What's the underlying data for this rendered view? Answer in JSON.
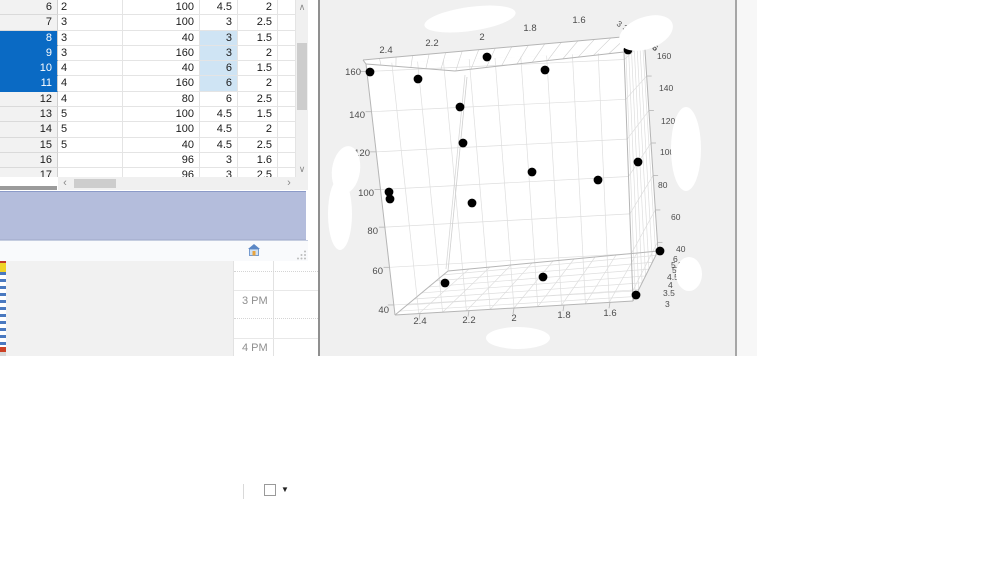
{
  "table": {
    "selection_color": "#0a6ac4",
    "cell_highlight_color": "#cfe4f4",
    "rows": [
      {
        "n": "6",
        "c1": "2",
        "c2": "100",
        "c3": "4.5",
        "c4": "2",
        "sel": false,
        "hl": false
      },
      {
        "n": "7",
        "c1": "3",
        "c2": "100",
        "c3": "3",
        "c4": "2.5",
        "sel": false,
        "hl": false
      },
      {
        "n": "8",
        "c1": "3",
        "c2": "40",
        "c3": "3",
        "c4": "1.5",
        "sel": true,
        "hl": true
      },
      {
        "n": "9",
        "c1": "3",
        "c2": "160",
        "c3": "3",
        "c4": "2",
        "sel": true,
        "hl": true
      },
      {
        "n": "10",
        "c1": "4",
        "c2": "40",
        "c3": "6",
        "c4": "1.5",
        "sel": true,
        "hl": true
      },
      {
        "n": "11",
        "c1": "4",
        "c2": "160",
        "c3": "6",
        "c4": "2",
        "sel": true,
        "hl": true
      },
      {
        "n": "12",
        "c1": "4",
        "c2": "80",
        "c3": "6",
        "c4": "2.5",
        "sel": false,
        "hl": false
      },
      {
        "n": "13",
        "c1": "5",
        "c2": "100",
        "c3": "4.5",
        "c4": "1.5",
        "sel": false,
        "hl": false
      },
      {
        "n": "14",
        "c1": "5",
        "c2": "100",
        "c3": "4.5",
        "c4": "2",
        "sel": false,
        "hl": false
      },
      {
        "n": "15",
        "c1": "5",
        "c2": "40",
        "c3": "4.5",
        "c4": "2.5",
        "sel": false,
        "hl": false
      },
      {
        "n": "16",
        "c1": "",
        "c2": "96",
        "c3": "3",
        "c4": "1.6",
        "sel": false,
        "hl": false
      },
      {
        "n": "17",
        "c1": "",
        "c2": "96",
        "c3": "3",
        "c4": "2.5",
        "sel": false,
        "hl": false
      }
    ]
  },
  "status_bar": {
    "icons": [
      "home-icon",
      "white-square-button",
      "dropdown-arrow-icon"
    ],
    "dropdown_glyph": "▼"
  },
  "scrollbars": {
    "up_glyph": "∧",
    "down_glyph": "∨",
    "left_glyph": "‹",
    "right_glyph": "›"
  },
  "calendar": {
    "labels": [
      "3 PM",
      "4 PM"
    ]
  },
  "chart_data": {
    "type": "scatter3d",
    "title": "",
    "x_axis": {
      "ticks": [
        "2.4",
        "2.2",
        "2",
        "1.8",
        "1.6"
      ],
      "range": [
        1.5,
        2.5
      ]
    },
    "y_axis": {
      "ticks": [
        "160",
        "140",
        "120",
        "100",
        "80",
        "60",
        "40"
      ],
      "range": [
        40,
        160
      ]
    },
    "z_axis": {
      "ticks": [
        "3",
        "3.5",
        "4",
        "4.5",
        "5",
        "5.5",
        "6"
      ],
      "range": [
        3,
        6
      ]
    },
    "marker": {
      "color": "#000000",
      "radius": 4.4
    },
    "grid": true,
    "points_px": [
      [
        49,
        72
      ],
      [
        97,
        79
      ],
      [
        166,
        57
      ],
      [
        224,
        70
      ],
      [
        307,
        50
      ],
      [
        139,
        107
      ],
      [
        142,
        143
      ],
      [
        211,
        172
      ],
      [
        277,
        180
      ],
      [
        317,
        162
      ],
      [
        68,
        192
      ],
      [
        69,
        199
      ],
      [
        151,
        203
      ],
      [
        339,
        251
      ],
      [
        124,
        283
      ],
      [
        222,
        277
      ],
      [
        315,
        295
      ]
    ]
  }
}
